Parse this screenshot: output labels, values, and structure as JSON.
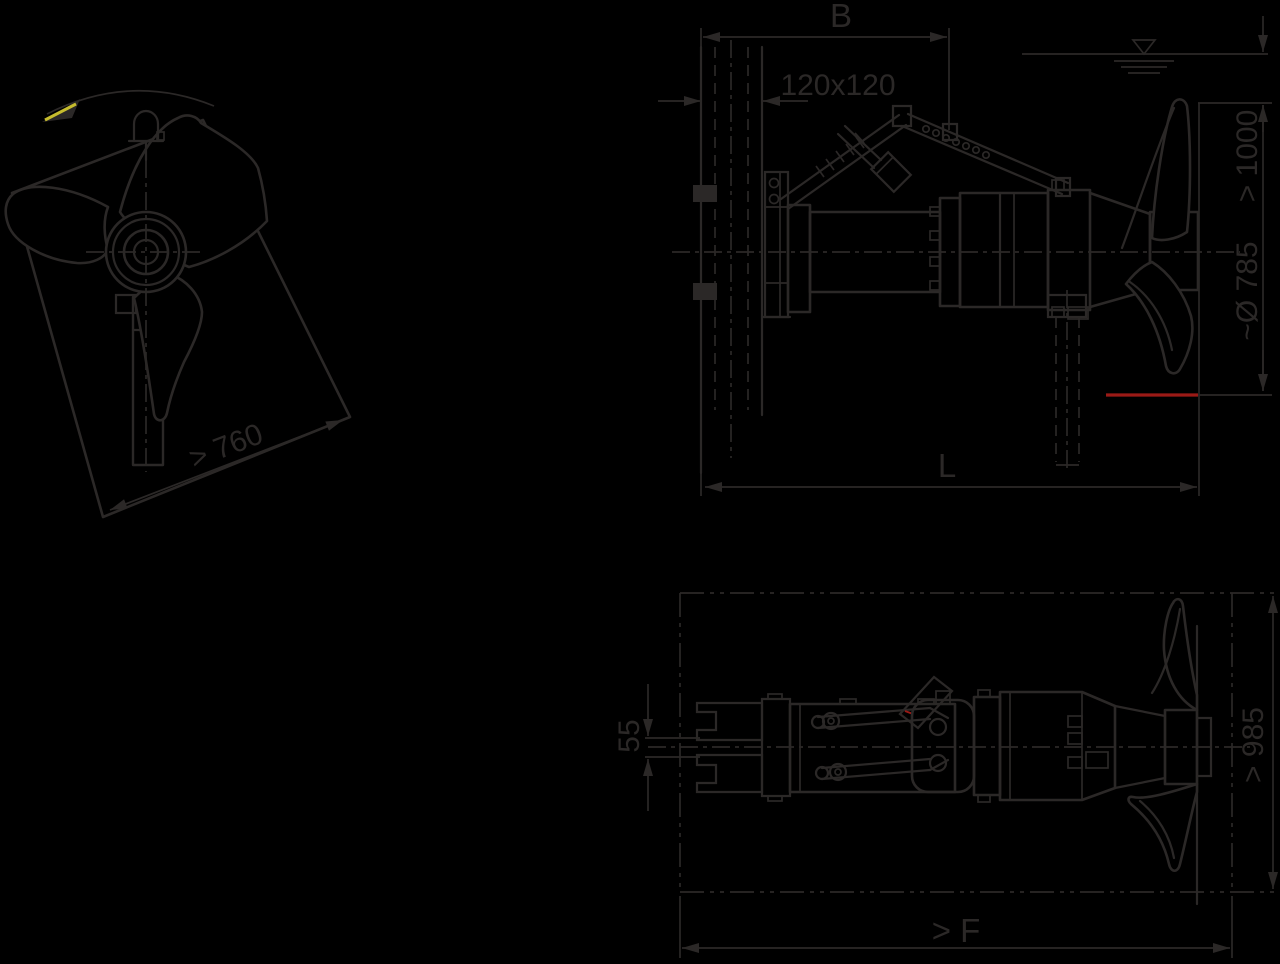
{
  "drawing": {
    "type": "technical-installation-drawing",
    "subject": "submersible mixer on guide rail, three orthographic views with installation dimensions",
    "background_color": "#000000",
    "line_color": "#2b2827",
    "red_accent_color": "#9b1a16",
    "yellow_accent_color": "#c6bc2e",
    "icons": {
      "water_level": "water-level-icon",
      "rotation_direction": "rotation-arrow-icon",
      "lifting_shackle": "shackle-icon"
    }
  },
  "dims": {
    "front": {
      "clearance_diagonal": "> 760"
    },
    "side": {
      "b": "B",
      "rail": "120x120",
      "submergence": "> 1000",
      "propeller_diameter": "~Ø 785",
      "length": "L"
    },
    "plan": {
      "claw_gap": "55",
      "clearance_width": "> 985",
      "clearance_floor": "> F"
    }
  }
}
